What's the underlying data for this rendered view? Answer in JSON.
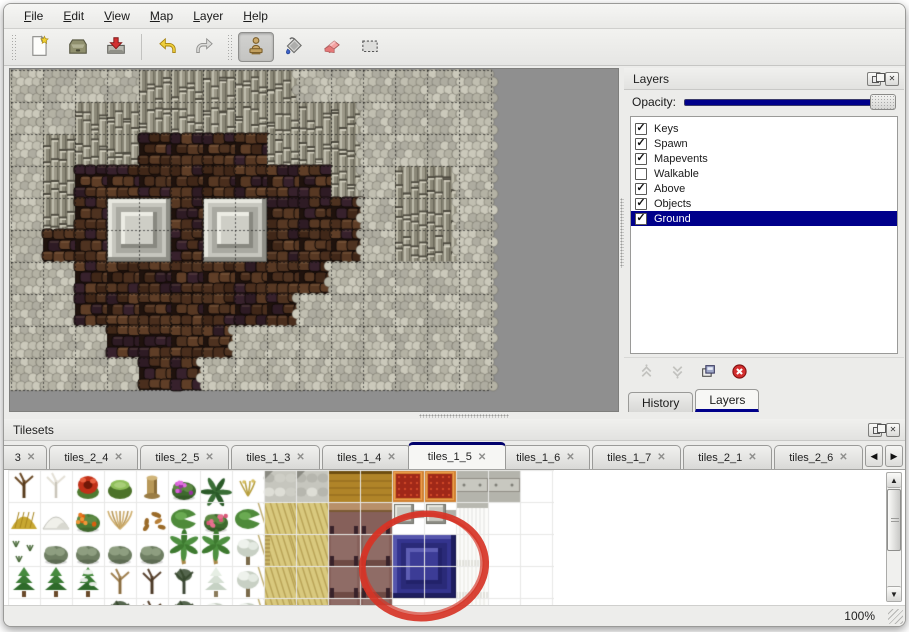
{
  "menu": {
    "items": [
      "File",
      "Edit",
      "View",
      "Map",
      "Layer",
      "Help"
    ]
  },
  "toolbar": {
    "buttons": [
      {
        "name": "new",
        "icon": "new-file-icon",
        "selected": false
      },
      {
        "name": "open",
        "icon": "open-icon",
        "selected": false
      },
      {
        "name": "save",
        "icon": "save-icon",
        "selected": false
      },
      {
        "name": "undo",
        "icon": "undo-icon",
        "selected": false
      },
      {
        "name": "redo",
        "icon": "redo-icon",
        "selected": false
      },
      {
        "name": "stamp",
        "icon": "stamp-tool-icon",
        "selected": true
      },
      {
        "name": "fill",
        "icon": "fill-tool-icon",
        "selected": false
      },
      {
        "name": "eraser",
        "icon": "eraser-tool-icon",
        "selected": false
      },
      {
        "name": "select",
        "icon": "select-tool-icon",
        "selected": false
      }
    ]
  },
  "map_view": {
    "tile_size": 32,
    "columns": 15,
    "rows": 10,
    "terrain_legend": {
      "S": "stone-scale-ground",
      "C": "cliff-face",
      "F": "dark-cobble-floor"
    },
    "grid": [
      "SSSSCCCCCSSSSSS",
      "SSCCCCCCCCCSSSS",
      "SCCCFFFFCCCSSSS",
      "SCFFFFFFFFCSCCS",
      "SCFFFFFFFFFSCCS",
      "SFFFFFFFFFFSCCS",
      "SSFFFFFFFFSSSSS",
      "SSFFFFFFFSSSSSS",
      "SSSFFFFSSSSSSSS",
      "SSSSFFSSSSSSSSS"
    ],
    "pedestals": [
      {
        "col": 3,
        "row": 4
      },
      {
        "col": 6,
        "row": 4
      }
    ],
    "background": "#8F8F8F"
  },
  "layers_panel": {
    "title": "Layers",
    "opacity_label": "Opacity:",
    "opacity_value": 100,
    "layers": [
      {
        "name": "Keys",
        "visible": true,
        "selected": false
      },
      {
        "name": "Spawn",
        "visible": true,
        "selected": false
      },
      {
        "name": "Mapevents",
        "visible": true,
        "selected": false
      },
      {
        "name": "Walkable",
        "visible": false,
        "selected": false
      },
      {
        "name": "Above",
        "visible": true,
        "selected": false
      },
      {
        "name": "Objects",
        "visible": true,
        "selected": false
      },
      {
        "name": "Ground",
        "visible": true,
        "selected": true
      }
    ],
    "buttons": [
      "move-layer-up",
      "move-layer-down",
      "duplicate-layer",
      "delete-layer"
    ],
    "tabs": [
      "History",
      "Layers"
    ],
    "active_tab": "Layers",
    "selection_color": "#00008B",
    "slider_color": "#00008B"
  },
  "tilesets_panel": {
    "title": "Tilesets",
    "tabs": [
      "3",
      "tiles_2_4",
      "tiles_2_5",
      "tiles_1_3",
      "tiles_1_4",
      "tiles_1_5",
      "tiles_1_6",
      "tiles_1_7",
      "tiles_2_1",
      "tiles_2_6"
    ],
    "active_tab": "tiles_1_5",
    "tile_size": 32,
    "tile_grid": [
      [
        "branchtree",
        "whitetree",
        "redflower",
        "stump",
        "trunk",
        "purpleflower",
        "fern",
        "sprig",
        "cobble",
        "cobble",
        "wood",
        "wood",
        "carpet",
        "carpet",
        "stone",
        "stone",
        "blank"
      ],
      [
        "hay",
        "snowmound",
        "orangeflower",
        "drygrass",
        "leaves",
        "lilypad",
        "roses",
        "lilypad",
        "tanfloor",
        "tanfloor",
        "tabletop",
        "tabletop",
        "pillar",
        "pillar",
        "curtaintop",
        "blank",
        "blank"
      ],
      [
        "sprouts",
        "bush",
        "bush",
        "bush",
        "bush",
        "palm",
        "palm",
        "snowtree",
        "tanfloor2",
        "tanfloor",
        "table",
        "table",
        "blue",
        "blue2",
        "curtain",
        "blank",
        "blank"
      ],
      [
        "conifer",
        "conifer",
        "conifersnow",
        "deadtan",
        "deaddark",
        "darktree",
        "snowconifer",
        "snowtree",
        "tanfloor",
        "tanfloor",
        "table",
        "table",
        "blue2",
        "blue2",
        "curtain",
        "blank",
        "blank"
      ],
      [
        "bush",
        "bush",
        "bush",
        "darktree",
        "deaddark",
        "darktree",
        "snowtree",
        "snowtree",
        "tanfloor",
        "tanfloor",
        "table",
        "table",
        "blank",
        "blank",
        "curtain",
        "blank",
        "blank"
      ]
    ],
    "annotation": {
      "shape": "hand-drawn-ellipse",
      "color": "#D63426",
      "circled_tile": "blue-table-block"
    }
  },
  "status_bar": {
    "zoom_level": "100%"
  }
}
